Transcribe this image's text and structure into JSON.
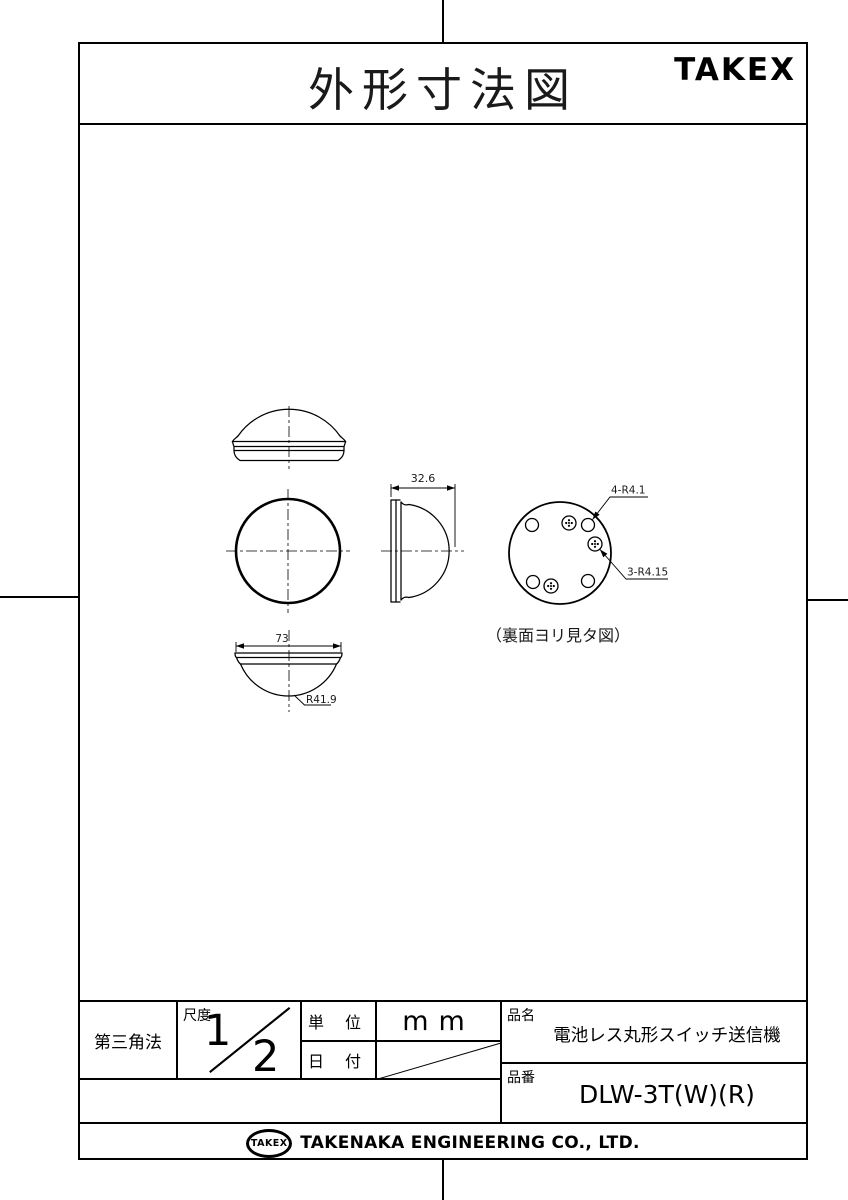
{
  "header": {
    "title": "外形寸法図",
    "brand": "TAKEX"
  },
  "drawing": {
    "dim_depth": "32.6",
    "dim_width": "73",
    "dim_radius": "R41.9",
    "label_round_holes": "4-R4.1",
    "label_screw_holes": "3-R4.15",
    "back_view_caption": "（裏面ヨリ見タ図）"
  },
  "title_block": {
    "projection": "第三角法",
    "scale_label": "尺度",
    "scale_numerator": "1",
    "scale_denominator": "2",
    "unit_label": "単 位",
    "unit_value": "mm",
    "date_label": "日 付",
    "product_name_label": "品名",
    "product_name": "電池レス丸形スイッチ送信機",
    "part_number_label": "品番",
    "part_number": "DLW-3T(W)(R)"
  },
  "footer": {
    "logo_text": "TAKEX",
    "company_name": "TAKENAKA ENGINEERING CO., LTD."
  }
}
